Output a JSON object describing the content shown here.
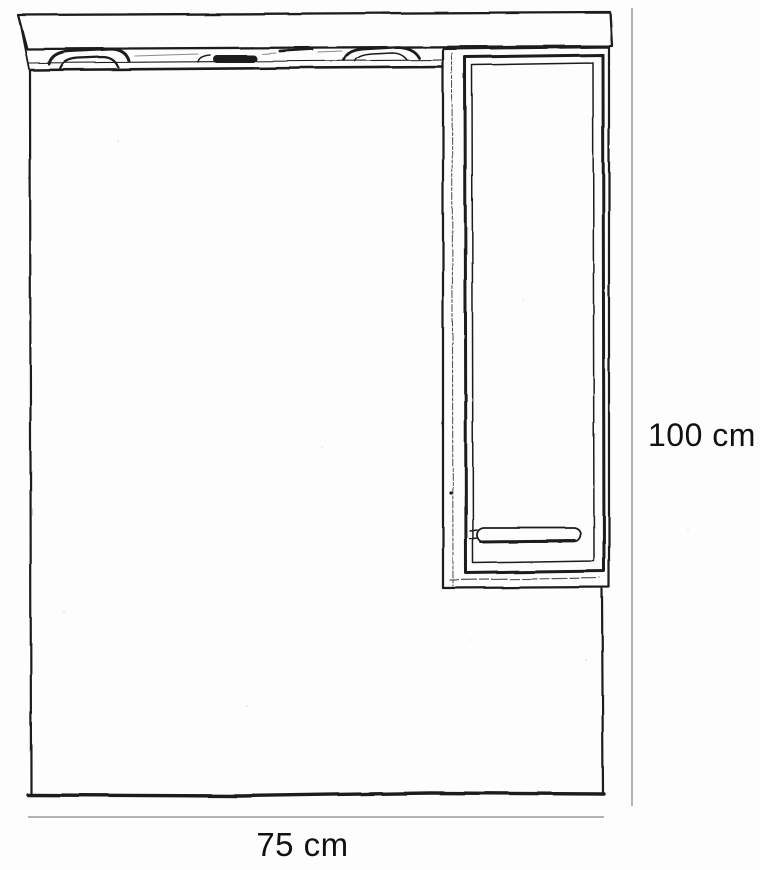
{
  "diagram": {
    "kind": "furniture-dimension-drawing",
    "dimensions": {
      "height_label": "100 cm",
      "width_label": "75 cm"
    },
    "parts": {
      "canopy": "canopy-shelf",
      "lamps": [
        "lamp-left",
        "lamp-center",
        "lamp-right"
      ],
      "mirror": "mirror-panel",
      "cabinet": "side-cabinet",
      "door": "cabinet-door",
      "handle": "door-handle"
    },
    "colors": {
      "line": "#1c1c1c",
      "dimension_line": "#9b9b9b",
      "label_text": "#111111",
      "background": "#fdfdfd"
    }
  }
}
